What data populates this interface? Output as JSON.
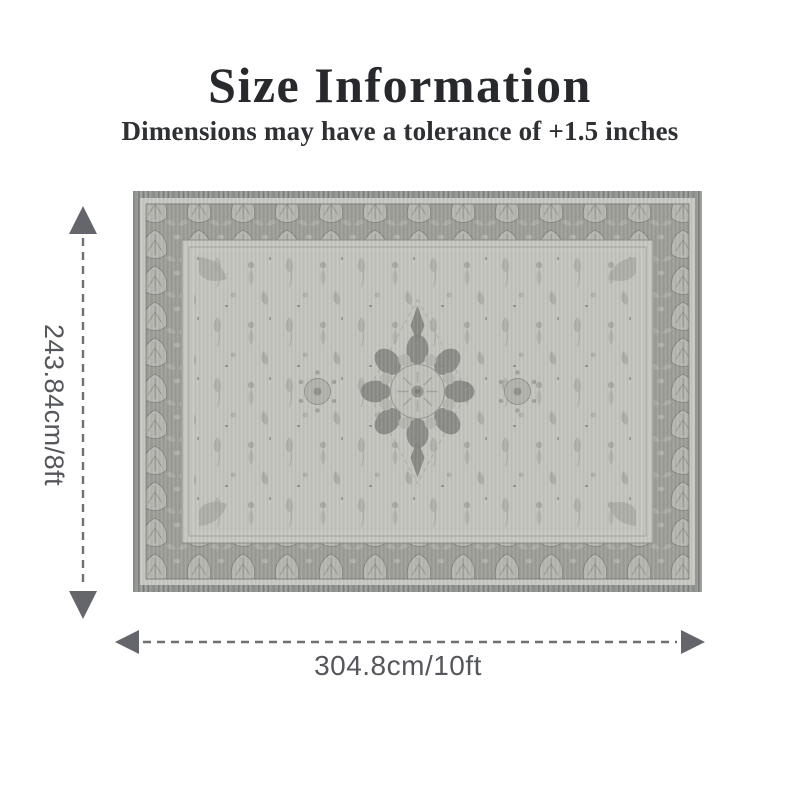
{
  "header": {
    "title": "Size Information",
    "subtitle": "Dimensions may have a tolerance of +1.5 inches"
  },
  "product": {
    "image_alt": "Faded gray vintage oriental area rug with central medallion and floral leaf border"
  },
  "dimensions": {
    "height_label": "243.84cm/8ft",
    "width_label": "304.8cm/10ft"
  },
  "colors": {
    "title_text": "#27292c",
    "dimension_text": "#55575c",
    "arrow": "#64666c",
    "rug_field": "#c3c2bc",
    "rug_border": "#9c9c97",
    "rug_accent": "#81827d",
    "background": "#ffffff"
  }
}
